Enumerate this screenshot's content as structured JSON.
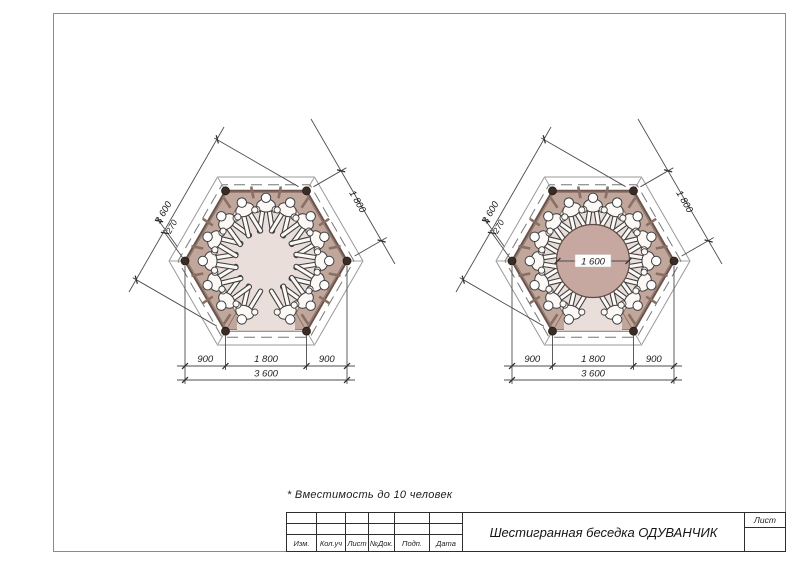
{
  "sheet": {
    "note": "* Вместимость до 10 человек",
    "title_block": {
      "revision_columns": [
        "Изм.",
        "Кол.уч",
        "Лист",
        "№Док.",
        "Подп.",
        "Дата"
      ],
      "title": "Шестигранная беседка ОДУВАНЧИК",
      "sheet_label": "Лист"
    }
  },
  "drawings": {
    "left_plan": {
      "dim_diagonal": "3 600",
      "dim_side": "1 800",
      "dim_bench_depth": "270",
      "dim_bottom_left": "900",
      "dim_bottom_center": "1 800",
      "dim_bottom_right": "900",
      "dim_bottom_total": "3 600"
    },
    "right_plan": {
      "dim_diagonal": "3 600",
      "dim_side": "1 800",
      "dim_bench_depth": "270",
      "dim_table_diameter": "1 600",
      "dim_bottom_left": "900",
      "dim_bottom_center": "1 800",
      "dim_bottom_right": "900",
      "dim_bottom_total": "3 600"
    }
  },
  "colors": {
    "bench_ring": "#c1a69b",
    "wall_line": "#6b544b",
    "floor": "#e9deda",
    "table": "#c6a8a0",
    "post": "#3a2d26",
    "person_fill": "#fbf8f6",
    "dimension_line": "#4d4d4d",
    "roof_line": "#999999"
  }
}
